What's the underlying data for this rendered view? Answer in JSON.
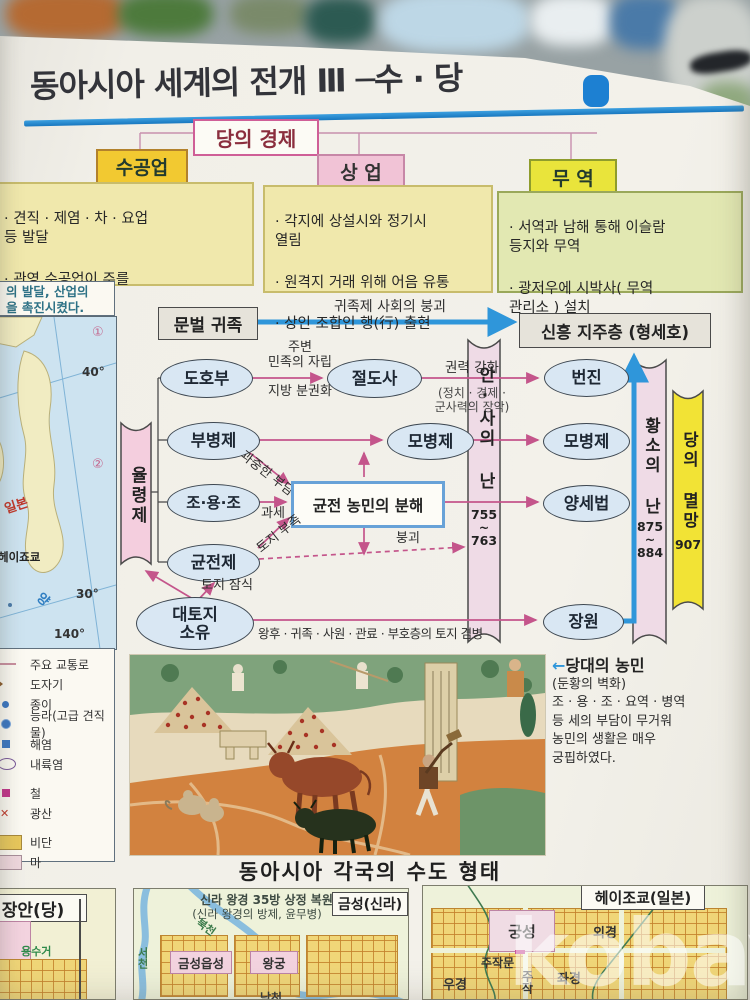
{
  "page": {
    "title": "동아시아 세계의 전개 Ⅲ ─수 · 당",
    "page_number": "69"
  },
  "economy": {
    "title": "당의 경제",
    "handicraft": {
      "label": "수공업",
      "items": [
        "· 견직 · 제염 · 차 · 요업\n등 발달",
        "· 관영 수공업이 주를\n이룸"
      ]
    },
    "commerce": {
      "label": "상 업",
      "items": [
        "· 각지에 상설시와 정기시\n열림",
        "· 원격지 거래 위해 어음 유통",
        "· 상인 조합인 행(行) 출현"
      ]
    },
    "trade": {
      "label": "무 역",
      "items": [
        "· 서역과 남해 통해 이슬람\n등지와 무역",
        "· 광저우에 시박사( 무역\n관리소 ) 설치"
      ]
    }
  },
  "sidebar": {
    "caption_line1": "의 발달, 산업의",
    "caption_line2": "을 촉진시켰다.",
    "map": {
      "marker1": "①",
      "marker2": "②",
      "lat40": "40°",
      "lat30": "30°",
      "lon140": "140°",
      "japan": "일본",
      "heijokyo": "헤이죠쿄",
      "sea": "양"
    },
    "legend": [
      "주요 교통로",
      "도자기",
      "종이",
      "능라(고급 견직물)",
      "해염",
      "내륙염",
      "철",
      "광산",
      "비단",
      "마"
    ]
  },
  "diagram": {
    "munbeol": "문벌 귀족",
    "breakup": "귀족제 사회의 붕괴",
    "sinheung": "신흥 지주층 (형세호)",
    "yulryeongje": "율령제",
    "dohobu": "도호부",
    "jubyeon": "주변\n민족의 자립",
    "jibang": "지방 분권화",
    "jeoldosa": "절도사",
    "gwonryeok": "권력 강화",
    "jangak": "(정치 · 경제 ·\n군사력의 장악)",
    "beonjin": "번진",
    "bubyeongje": "부병제",
    "mobyeongje_pre": "모병제",
    "mobyeongje_post": "모병제",
    "joyongjo": "조·용·조",
    "gwajung": "과중한 부담",
    "gwase": "과세",
    "bunhae": "균전 농민의 분해",
    "yangsebeop": "양세법",
    "gyunjeonje": "균전제",
    "tojibujok": "토지 부족",
    "bonggoe": "붕괴",
    "tojijamsik": "토지 잠식",
    "daetoji": "대토지\n소유",
    "gyeombyeong": "왕후 · 귀족 · 사원 · 관료 · 부호층의 토지 겸병",
    "jangwon": "장원",
    "ansa": "안·사의 난",
    "ansa_years": "755\n~\n763",
    "hwangso": "황소의 난",
    "hwangso_years": "875\n~\n884",
    "myeolmang": "당의 멸망",
    "myeolmang_year": "907"
  },
  "mural_caption": {
    "arrow": "←",
    "title": "당대의 농민",
    "lines": [
      "(둔황의 벽화)",
      "조 · 용 · 조 · 요역 · 병역",
      "등 세의 부담이 무거워",
      "농민의 생활은 매우",
      "궁핍하였다."
    ]
  },
  "capitals": {
    "heading": "동아시아 각국의 수도 형태",
    "changan": {
      "title": "장안(당)",
      "label_canal": "용수거"
    },
    "geumseong": {
      "title": "금성(신라)",
      "note_line1": "신라 왕경 35방 상정 복원도",
      "note_line2": "(신라 왕경의 방제, 윤무병)",
      "label_west": "서천",
      "label_north": "북천",
      "label_fort": "금성읍성",
      "label_palace": "왕궁",
      "label_south": "남천"
    },
    "heijokyo": {
      "title": "헤이조쿄(일본)",
      "label_palace": "궁성",
      "label_gate": "주작문",
      "label_outer": "외경",
      "label_right": "우경",
      "label_left": "좌경",
      "label_suzaku": "주작"
    }
  },
  "watermark": "kobay"
}
